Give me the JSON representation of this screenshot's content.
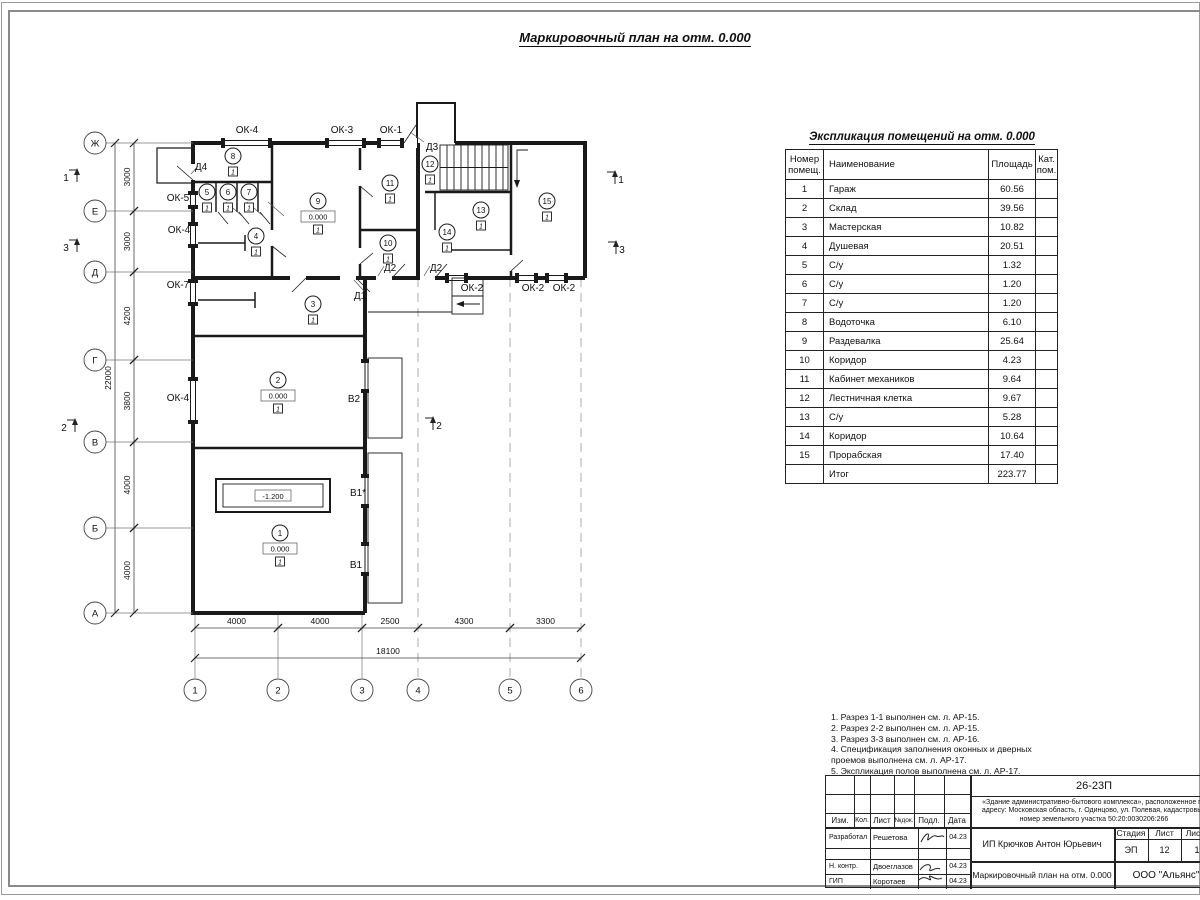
{
  "sheet_title": "Маркировочный план на отм. 0.000",
  "schedule": {
    "title": "Экспликация помещений на отм. 0.000",
    "headers": {
      "num": "Номер\nпомещ.",
      "name": "Наименование",
      "area": "Площадь",
      "cat": "Кат.\nпом."
    },
    "rows": [
      {
        "num": "1",
        "name": "Гараж",
        "area": "60.56"
      },
      {
        "num": "2",
        "name": "Склад",
        "area": "39.56"
      },
      {
        "num": "3",
        "name": "Мастерская",
        "area": "10.82"
      },
      {
        "num": "4",
        "name": "Душевая",
        "area": "20.51"
      },
      {
        "num": "5",
        "name": "С/у",
        "area": "1.32"
      },
      {
        "num": "6",
        "name": "С/у",
        "area": "1.20"
      },
      {
        "num": "7",
        "name": "С/у",
        "area": "1.20"
      },
      {
        "num": "8",
        "name": "Водоточка",
        "area": "6.10"
      },
      {
        "num": "9",
        "name": "Раздевалка",
        "area": "25.64"
      },
      {
        "num": "10",
        "name": "Коридор",
        "area": "4.23"
      },
      {
        "num": "11",
        "name": "Кабинет механиков",
        "area": "9.64"
      },
      {
        "num": "12",
        "name": "Лестничная клетка",
        "area": "9.67"
      },
      {
        "num": "13",
        "name": "С/у",
        "area": "5.28"
      },
      {
        "num": "14",
        "name": "Коридор",
        "area": "10.64"
      },
      {
        "num": "15",
        "name": "Прорабская",
        "area": "17.40"
      },
      {
        "num": "",
        "name": "Итог",
        "area": "223.77"
      }
    ]
  },
  "notes": [
    "1. Разрез 1-1 выполнен см. л. АР-15.",
    "2. Разрез 2-2 выполнен см. л. АР-15.",
    "3. Разрез 3-3 выполнен см. л. АР-16.",
    "4. Спецификация заполнения оконных и дверных",
    "    проемов выполнена см. л. АР-17.",
    "5. Экспликация полов выполнена см. л. АР-17."
  ],
  "plan": {
    "floor_mark": "1",
    "labels": [
      {
        "t": "ОК-4",
        "x": 227,
        "y": 53
      },
      {
        "t": "ОК-3",
        "x": 322,
        "y": 53
      },
      {
        "t": "ОК-1",
        "x": 371,
        "y": 53
      },
      {
        "t": "Д3",
        "x": 412,
        "y": 70
      },
      {
        "t": "Д4",
        "x": 181,
        "y": 90
      },
      {
        "t": "ОК-5",
        "x": 158,
        "y": 121
      },
      {
        "t": "ОК-4",
        "x": 159,
        "y": 153
      },
      {
        "t": "ОК-7",
        "x": 158,
        "y": 208
      },
      {
        "t": "ОК-4",
        "x": 158,
        "y": 321
      },
      {
        "t": "Д2",
        "x": 370,
        "y": 191
      },
      {
        "t": "Д2",
        "x": 416,
        "y": 191
      },
      {
        "t": "Д1",
        "x": 340,
        "y": 219
      },
      {
        "t": "ОК-2",
        "x": 452,
        "y": 211
      },
      {
        "t": "ОК-2",
        "x": 513,
        "y": 211
      },
      {
        "t": "ОК-2",
        "x": 544,
        "y": 211
      },
      {
        "t": "В2",
        "x": 334,
        "y": 322
      },
      {
        "t": "В1*",
        "x": 338,
        "y": 416
      },
      {
        "t": "В1",
        "x": 336,
        "y": 488
      }
    ],
    "rooms": [
      {
        "n": "8",
        "x": 213,
        "y": 76
      },
      {
        "n": "5",
        "x": 187,
        "y": 112
      },
      {
        "n": "6",
        "x": 208,
        "y": 112
      },
      {
        "n": "7",
        "x": 229,
        "y": 112
      },
      {
        "n": "9",
        "x": 298,
        "y": 121,
        "elev": "0.000"
      },
      {
        "n": "11",
        "x": 370,
        "y": 103
      },
      {
        "n": "12",
        "x": 410,
        "y": 84
      },
      {
        "n": "10",
        "x": 368,
        "y": 163
      },
      {
        "n": "13",
        "x": 461,
        "y": 130
      },
      {
        "n": "14",
        "x": 427,
        "y": 152
      },
      {
        "n": "15",
        "x": 527,
        "y": 121
      },
      {
        "n": "4",
        "x": 236,
        "y": 156
      },
      {
        "n": "3",
        "x": 293,
        "y": 224
      },
      {
        "n": "2",
        "x": 258,
        "y": 300,
        "elev": "0.000"
      },
      {
        "n": "1",
        "x": 260,
        "y": 453,
        "elev": "0.000"
      }
    ],
    "pit_elev": "-1.200",
    "row_axes": [
      {
        "label": "Ж",
        "y": 63
      },
      {
        "label": "Е",
        "y": 131
      },
      {
        "label": "Д",
        "y": 192
      },
      {
        "label": "Г",
        "y": 280
      },
      {
        "label": "В",
        "y": 362
      },
      {
        "label": "Б",
        "y": 448
      },
      {
        "label": "А",
        "y": 533
      }
    ],
    "col_axes": [
      {
        "label": "1",
        "x": 175
      },
      {
        "label": "2",
        "x": 258
      },
      {
        "label": "3",
        "x": 342
      },
      {
        "label": "4",
        "x": 398
      },
      {
        "label": "5",
        "x": 490
      },
      {
        "label": "6",
        "x": 561
      }
    ],
    "v_dims": [
      {
        "text": "3000",
        "y1": 63,
        "y2": 131
      },
      {
        "text": "3000",
        "y1": 131,
        "y2": 192
      },
      {
        "text": "4200",
        "y1": 192,
        "y2": 280
      },
      {
        "text": "3800",
        "y1": 280,
        "y2": 362
      },
      {
        "text": "4000",
        "y1": 362,
        "y2": 448
      },
      {
        "text": "4000",
        "y1": 448,
        "y2": 533
      }
    ],
    "total_v": "22000",
    "h_dims": [
      {
        "text": "4000",
        "x1": 175,
        "x2": 258
      },
      {
        "text": "4000",
        "x1": 258,
        "x2": 342
      },
      {
        "text": "2500",
        "x1": 342,
        "x2": 398
      },
      {
        "text": "4300",
        "x1": 398,
        "x2": 490
      },
      {
        "text": "3300",
        "x1": 490,
        "x2": 561
      }
    ],
    "total_h": "18100",
    "sections": [
      {
        "n": "1",
        "x": 57,
        "y": 86,
        "tx": 46,
        "ty": 101
      },
      {
        "n": "3",
        "x": 57,
        "y": 156,
        "tx": 46,
        "ty": 171
      },
      {
        "n": "2",
        "x": 55,
        "y": 336,
        "tx": 44,
        "ty": 351
      },
      {
        "n": "1",
        "x": 595,
        "y": 88,
        "tx": 601,
        "ty": 103
      },
      {
        "n": "3",
        "x": 596,
        "y": 158,
        "tx": 602,
        "ty": 173
      },
      {
        "n": "2",
        "x": 413,
        "y": 334,
        "tx": 419,
        "ty": 349
      }
    ]
  },
  "titleblock": {
    "doc_code": "26-23П",
    "description": "«Здание административно-бытового комплекса», расположенное по адресу: Московская область, г. Одинцово, ул. Полевая, кадастровый номер земельного участка 50:20:0030206:266",
    "cols": [
      "Изм.",
      "Кол.",
      "Лист",
      "№док.",
      "Подл.",
      "Дата"
    ],
    "sign_rows": [
      {
        "role": "Разработал",
        "name": "Решетова",
        "date": "04.23"
      },
      {
        "role": "Н. контр.",
        "name": "Двоеглазов",
        "date": "04.23"
      },
      {
        "role": "ГИП",
        "name": "Коротаев",
        "date": "04.23"
      }
    ],
    "client": "ИП Крючков Антон Юрьевич",
    "stage_headers": [
      "Стадия",
      "Лист",
      "Листов"
    ],
    "stage_values": [
      "ЭП",
      "12",
      "17"
    ],
    "sheet_name": "Маркировочный план на отм. 0.000",
    "company": "ООО \"Альянс\""
  }
}
